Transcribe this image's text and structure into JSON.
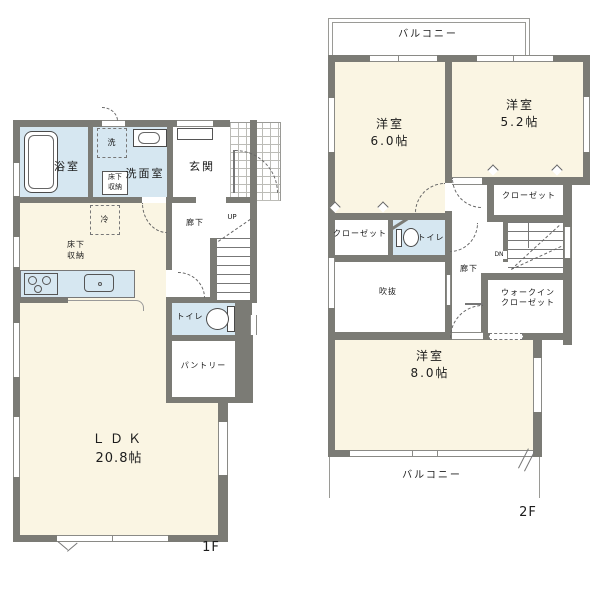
{
  "colors": {
    "wall": "#7b7b75",
    "room": "#faf5e3",
    "wet": "#d6e7f1",
    "line": "#666666",
    "grid": "#bcbcb7"
  },
  "f1": {
    "label": "1F",
    "bath": "浴室",
    "laundry": "洗",
    "washroom": "洗面室",
    "underfloor_small": "床下\n収納",
    "entrance": "玄関",
    "fridge": "冷",
    "underfloor": "床下\n収納",
    "hallway": "廊下",
    "up": "UP",
    "toilet": "トイレ",
    "pantry": "パントリー",
    "ldk": "ＬＤＫ",
    "ldk_size": "20.8帖"
  },
  "f2": {
    "label": "2F",
    "balcony_top": "バルコニー",
    "room6": "洋室",
    "room6_size": "6.0帖",
    "room52": "洋室",
    "room52_size": "5.2帖",
    "closet_right": "クローゼット",
    "closet_left": "クローゼット",
    "toilet": "トイレ",
    "dn": "DN",
    "hallway": "廊下",
    "void": "吹抜",
    "wic": "ウォークイン\nクローゼット",
    "room8": "洋室",
    "room8_size": "8.0帖",
    "balcony_bottom": "バルコニー"
  }
}
